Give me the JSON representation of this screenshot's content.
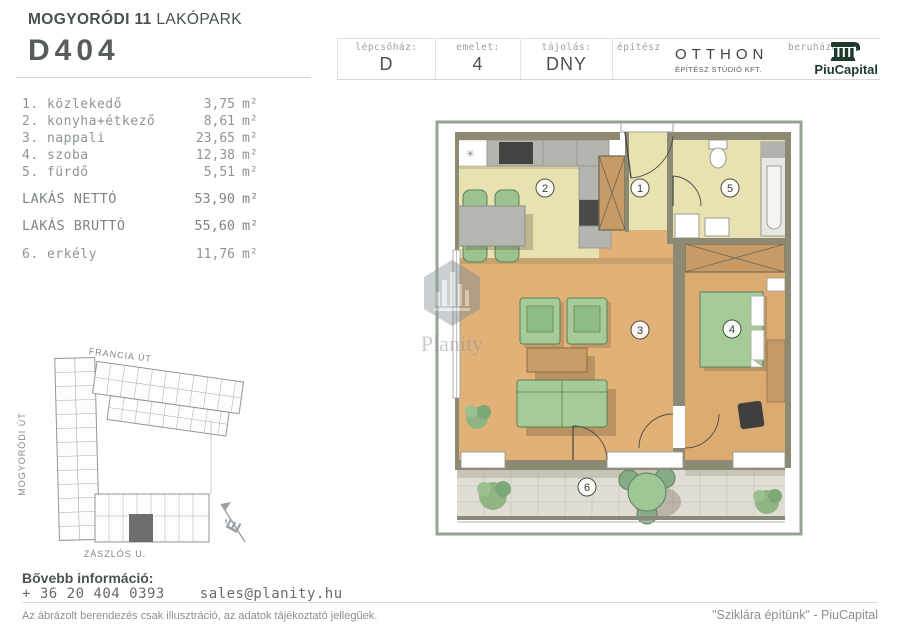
{
  "header": {
    "project": {
      "bold": "MOGYORÓDI 11",
      "light": "LAKÓPARK"
    },
    "unit_id": "D404",
    "info_cells": [
      {
        "label": "lépcsőház:",
        "value": "D"
      },
      {
        "label": "emelet:",
        "value": "4"
      },
      {
        "label": "tájolás:",
        "value": "DNY"
      }
    ],
    "architect": {
      "label": "építész",
      "name": "OTTHON",
      "sub": "ÉPÍTÉSZ STÚDIÓ KFT."
    },
    "developer": {
      "label": "beruházó",
      "name": "PiuCapital"
    }
  },
  "room_list": {
    "items": [
      {
        "num": "1.",
        "name": "közlekedő",
        "area": "3,75",
        "unit": "m²"
      },
      {
        "num": "2.",
        "name": "konyha+étkező",
        "area": "8,61",
        "unit": "m²"
      },
      {
        "num": "3.",
        "name": "nappali",
        "area": "23,65",
        "unit": "m²"
      },
      {
        "num": "4.",
        "name": "szoba",
        "area": "12,38",
        "unit": "m²"
      },
      {
        "num": "5.",
        "name": "fürdő",
        "area": "5,51",
        "unit": "m²"
      }
    ],
    "net": {
      "name": "LAKÁS NETTÓ",
      "area": "53,90",
      "unit": "m²"
    },
    "gross": {
      "name": "LAKÁS BRUTTÓ",
      "area": "55,60",
      "unit": "m²"
    },
    "balcony": {
      "num": "6.",
      "name": "erkély",
      "area": "11,76",
      "unit": "m²"
    }
  },
  "floor_plan": {
    "room_numbers": [
      "1",
      "2",
      "3",
      "4",
      "5",
      "6"
    ],
    "symbols": {
      "ceiling_light": "✳"
    }
  },
  "site_plan": {
    "street_top": "FRANCIA ÚT",
    "street_left": "MOGYORÓDI ÚT",
    "street_bottom": "ZÁSZLÓS U.",
    "north": "É"
  },
  "watermark": {
    "brand": "Planity"
  },
  "footer": {
    "info_label": "Bővebb információ:",
    "phone": "+ 36 20 404 0393",
    "email": "sales@planity.hu",
    "disclaimer": "Az ábrázolt berendezés csak illusztráció, az adatok tájékoztató jellegűek.",
    "slogan": "\"Sziklára építünk\" - PiuCapital"
  },
  "colors": {
    "brand_green": "#1d3a2c",
    "wall_olive": "#8d8a74",
    "floor_warm": "#e1b177",
    "floor_pale": "#e8e1b0",
    "furniture_green": "#a3cb97",
    "tile_gray": "#e0ddd4",
    "text_gray": "#8d968d",
    "frame_green": "#93a493"
  }
}
